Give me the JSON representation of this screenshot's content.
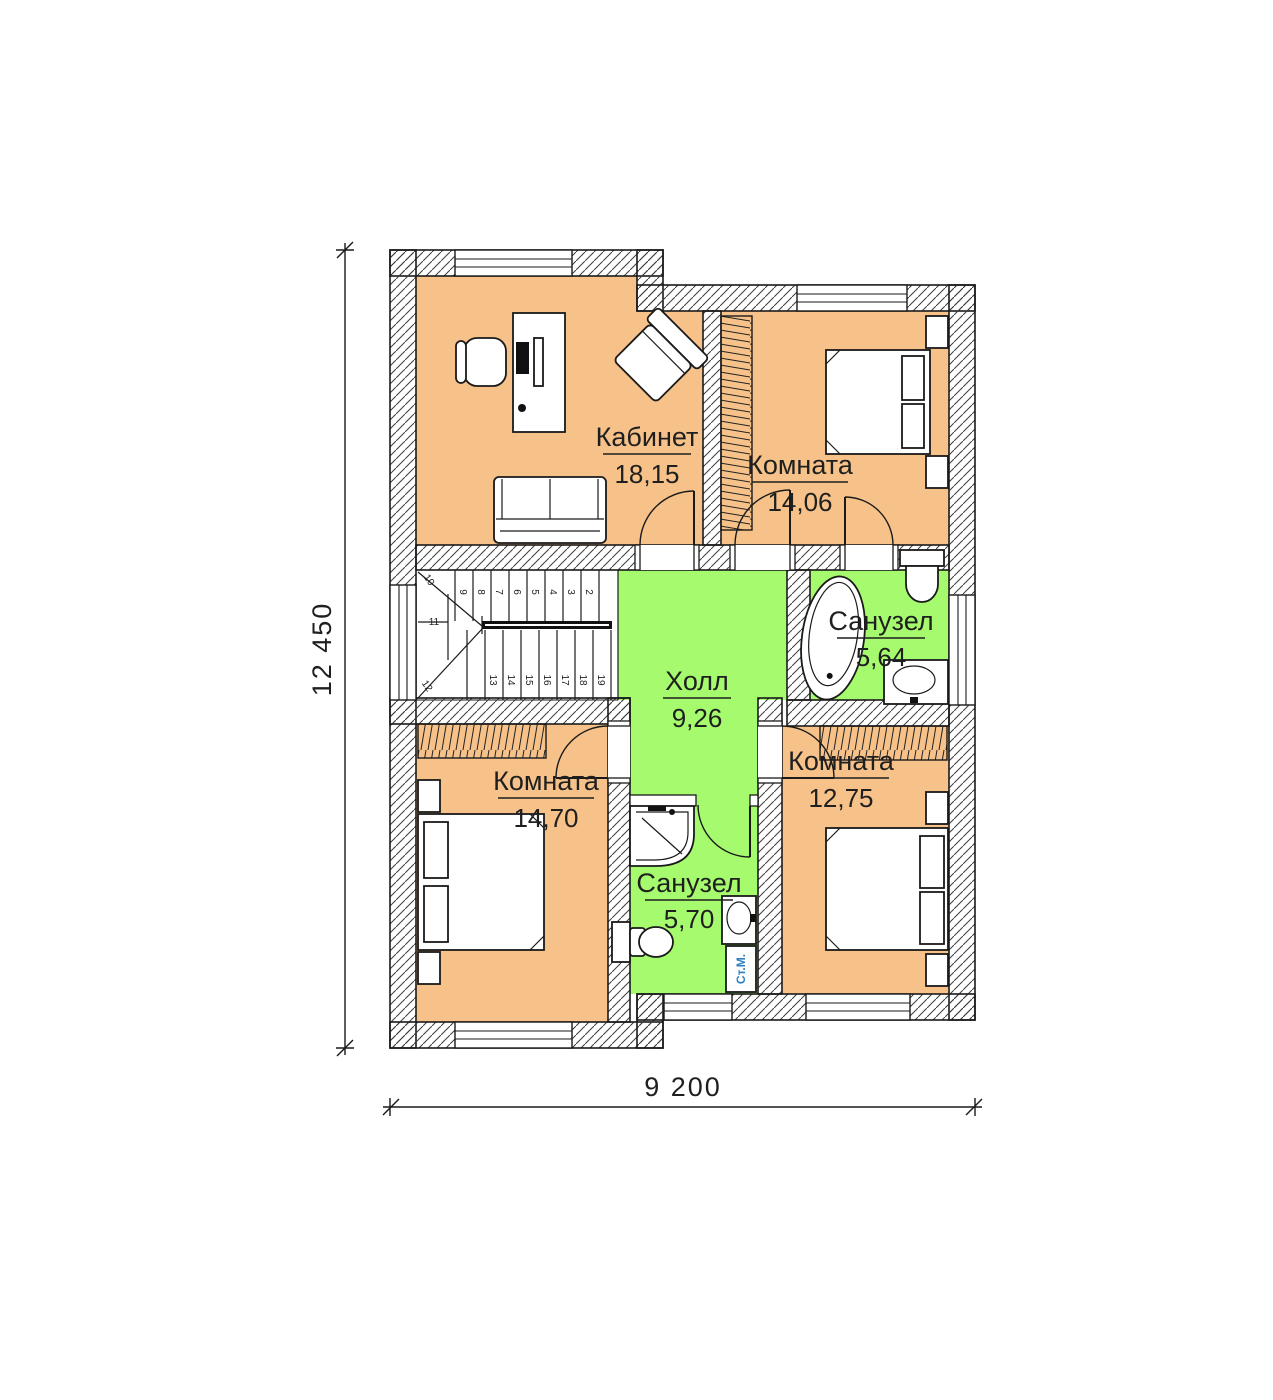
{
  "plan": {
    "colors": {
      "room_fill": "#f6c289",
      "wet_fill": "#a5fa6e",
      "wall_line": "#1a1a1a",
      "machine_label": "#2f7fc1",
      "background": "#ffffff"
    },
    "rooms": [
      {
        "name": "Кабинет",
        "area": "18,15"
      },
      {
        "name": "Комната",
        "area": "14,06"
      },
      {
        "name": "Холл",
        "area": "9,26"
      },
      {
        "name": "Санузел",
        "area": "5,64"
      },
      {
        "name": "Комната",
        "area": "14,70"
      },
      {
        "name": "Комната",
        "area": "12,75"
      },
      {
        "name": "Санузел",
        "area": "5,70"
      }
    ],
    "dimensions": {
      "height": "12 450",
      "width": "9 200"
    },
    "stairs": {
      "top_run": [
        "9",
        "8",
        "7",
        "6",
        "5",
        "4",
        "3",
        "2"
      ],
      "bottom_run": [
        "13",
        "14",
        "15",
        "16",
        "17",
        "18",
        "19"
      ],
      "winders": [
        "10",
        "11",
        "12"
      ]
    },
    "labels": {
      "washing_machine": "Ст.М."
    }
  }
}
